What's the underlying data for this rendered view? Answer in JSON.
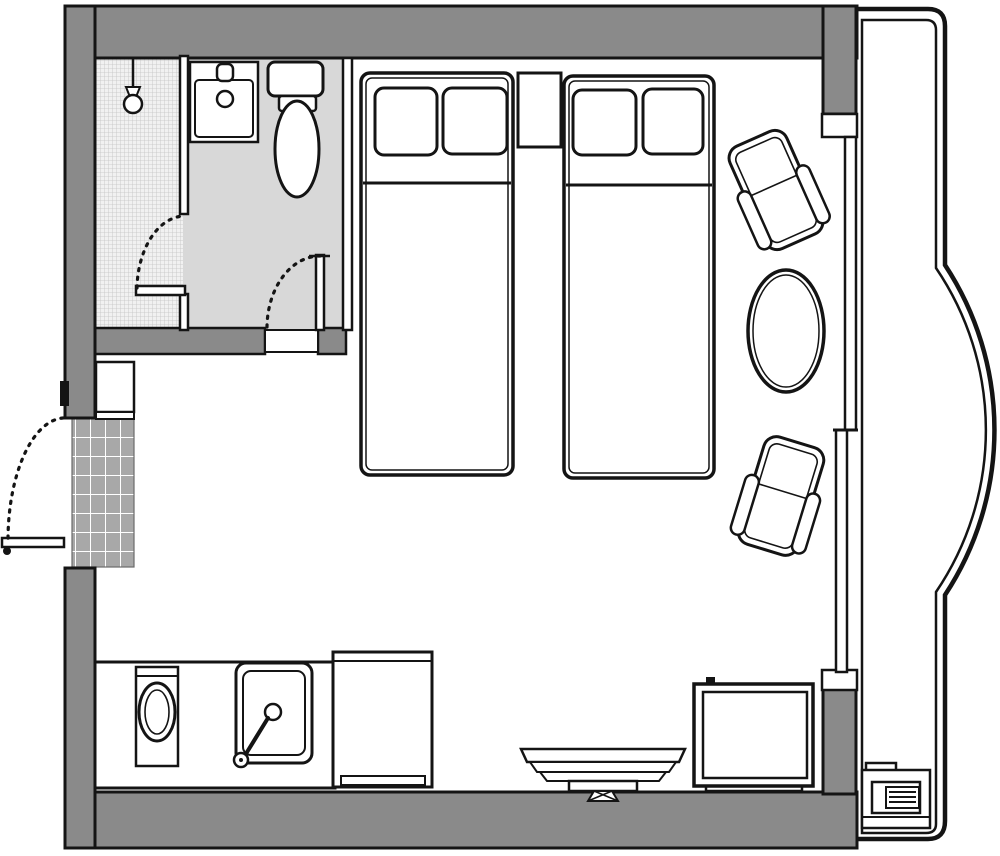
{
  "document": {
    "type": "floor-plan",
    "description": "Hotel guest room floor plan with bathroom, twin beds, sitting area, kitchenette and curved balcony"
  },
  "palette": {
    "wall": "#8a8a8a",
    "outline": "#141414",
    "floor": "#ffffff",
    "bathroom_floor": "#d8d8d8",
    "shower_hatch_line": "#c3c3c3",
    "shower_hatch_bg": "#f1f1f1",
    "mat": "#a8a8a8",
    "mat_grid": "#ffffff",
    "balcony_dot": "#8f8f8f",
    "balcony_bg": "#ffffff"
  },
  "rooms": [
    {
      "name": "shower-room"
    },
    {
      "name": "bathroom"
    },
    {
      "name": "entry"
    },
    {
      "name": "bedroom"
    },
    {
      "name": "kitchenette"
    },
    {
      "name": "balcony"
    }
  ],
  "furniture": [
    {
      "name": "shower-head"
    },
    {
      "name": "bathroom-sink"
    },
    {
      "name": "toilet"
    },
    {
      "name": "entry-closet"
    },
    {
      "name": "entry-mat"
    },
    {
      "name": "bed-1"
    },
    {
      "name": "bed-2"
    },
    {
      "name": "nightstand"
    },
    {
      "name": "armchair-1"
    },
    {
      "name": "armchair-2"
    },
    {
      "name": "round-table"
    },
    {
      "name": "tv"
    },
    {
      "name": "side-table"
    },
    {
      "name": "washing-machine"
    },
    {
      "name": "kitchen-sink"
    },
    {
      "name": "refrigerator"
    },
    {
      "name": "ac-unit"
    }
  ]
}
